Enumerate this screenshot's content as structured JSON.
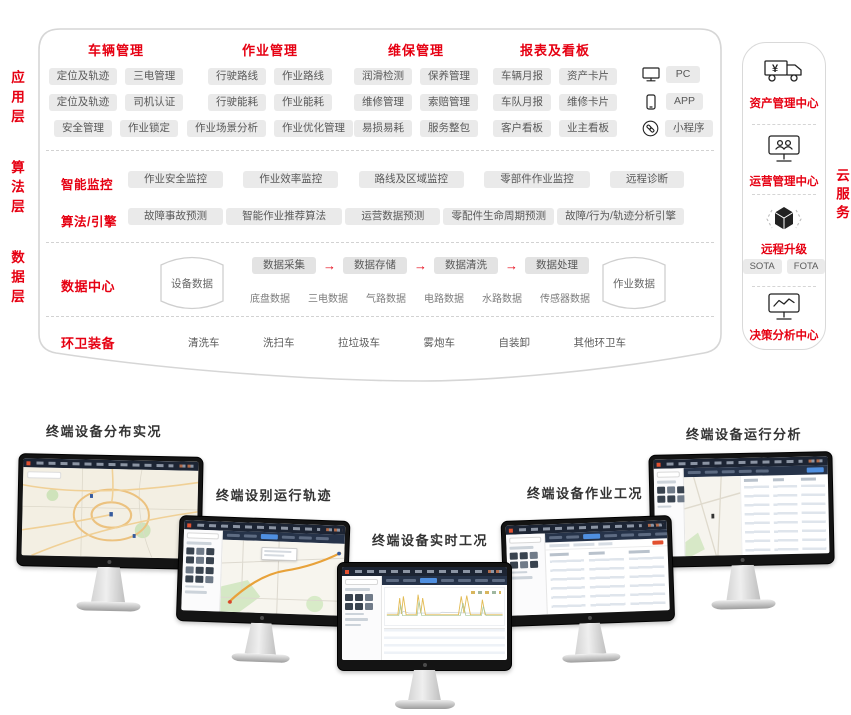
{
  "colors": {
    "accent": "#e60012"
  },
  "layers": {
    "app": "应用层",
    "algo": "算法层",
    "data": "数据层"
  },
  "cloud_side_label": "云服务",
  "app": {
    "groups": [
      {
        "title": "车辆管理",
        "rows": [
          [
            "定位及轨迹",
            "三电管理"
          ],
          [
            "定位及轨迹",
            "司机认证"
          ],
          [
            "安全管理",
            "作业锁定"
          ]
        ]
      },
      {
        "title": "作业管理",
        "rows": [
          [
            "行驶路线",
            "作业路线"
          ],
          [
            "行驶能耗",
            "作业能耗"
          ],
          [
            "作业场景分析",
            "作业优化管理"
          ]
        ]
      },
      {
        "title": "维保管理",
        "rows": [
          [
            "润滑检测",
            "保养管理"
          ],
          [
            "维修管理",
            "索赔管理"
          ],
          [
            "易损易耗",
            "服务整包"
          ]
        ]
      },
      {
        "title": "报表及看板",
        "rows": [
          [
            "车辆月报",
            "资产卡片"
          ],
          [
            "车队月报",
            "维修卡片"
          ],
          [
            "客户看板",
            "业主看板"
          ]
        ]
      }
    ],
    "platforms": [
      {
        "label": "PC"
      },
      {
        "label": "APP"
      },
      {
        "label": "小程序"
      }
    ]
  },
  "algo": {
    "monitor_label": "智能监控",
    "monitor_pills": [
      "作业安全监控",
      "作业效率监控",
      "路线及区域监控",
      "零部件作业监控",
      "远程诊断"
    ],
    "engine_label": "算法/引擎",
    "engine_pills": [
      "故障事故预测",
      "智能作业推荐算法",
      "运营数据预测",
      "零配件生命周期预测",
      "故障/行为/轨迹分析引擎"
    ]
  },
  "data_center": {
    "label": "数据中心",
    "device_store": "设备数据",
    "job_store": "作业数据",
    "arrow": "→",
    "pipeline": [
      "数据采集",
      "数据存储",
      "数据清洗",
      "数据处理"
    ],
    "sources": [
      "底盘数据",
      "三电数据",
      "气路数据",
      "电路数据",
      "水路数据",
      "传感器数据"
    ]
  },
  "equipment": {
    "label": "环卫装备",
    "items": [
      "清洗车",
      "洗扫车",
      "拉垃圾车",
      "雾炮车",
      "自装卸",
      "其他环卫车"
    ]
  },
  "cloud_panel": {
    "asset_label": "资产管理中心",
    "operation_label": "运营管理中心",
    "upgrade_label": "远程升级",
    "upgrade_pills": [
      "SOTA",
      "FOTA"
    ],
    "decision_label": "决策分析中心"
  },
  "monitors": [
    {
      "label": "终端设备分布实况"
    },
    {
      "label": "终端设别运行轨迹"
    },
    {
      "label": "终端设备实时工况"
    },
    {
      "label": "终端设备作业工况"
    },
    {
      "label": "终端设备运行分析"
    }
  ]
}
